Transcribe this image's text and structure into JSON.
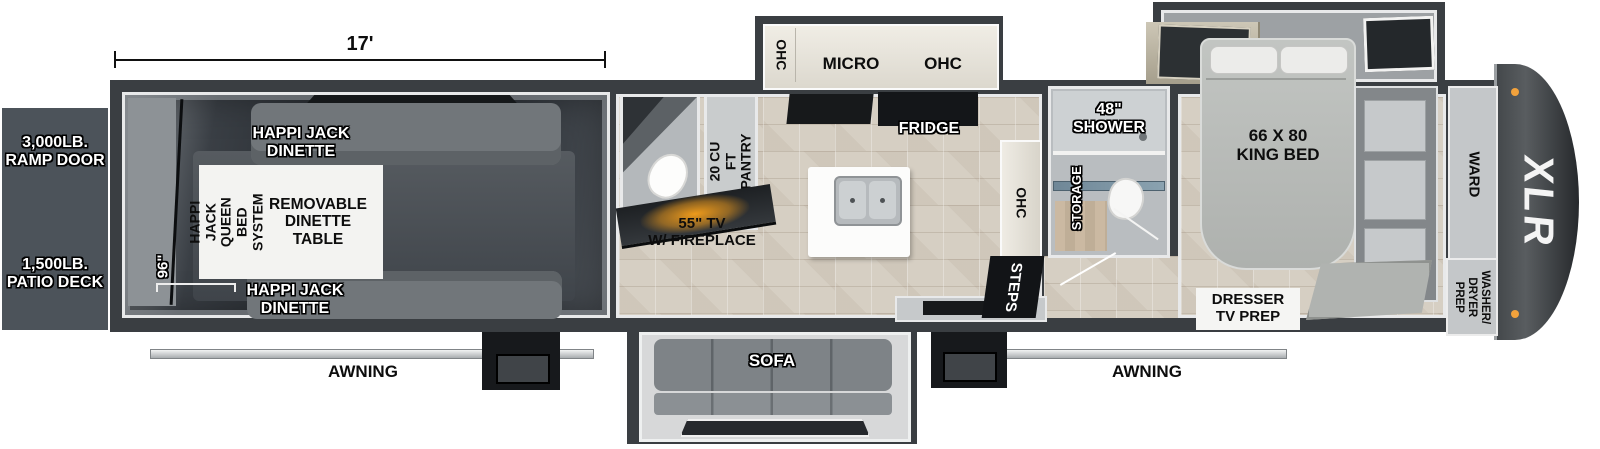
{
  "title": "XLR Toy Hauler Floorplan",
  "brand": "XLR",
  "colors": {
    "wall": "#3a3e42",
    "trim": "#e8e9ea",
    "ramp_box": "#4c535a",
    "tile_floor": "#d6cfc3",
    "garage_floor": "#2b2f34",
    "fireplace_glow": "#f59a1a",
    "marker_light": "#f2a23c"
  },
  "dimensions": {
    "garage_length": "17'",
    "garage_width": "96\""
  },
  "exterior": {
    "ramp_door": "3,000LB.\nRAMP DOOR",
    "patio_deck": "1,500LB.\nPATIO DECK",
    "awning_left": "AWNING",
    "awning_right": "AWNING"
  },
  "garage": {
    "dinette_top": "HAPPI JACK\nDINETTE",
    "dinette_bottom": "HAPPI JACK\nDINETTE",
    "queen_bed_system": "HAPPI JACK\nQUEEN BED\nSYSTEM",
    "dinette_table": "REMOVABLE\nDINETTE\nTABLE"
  },
  "entry": {
    "pantry": "20 CU FT\nPANTRY",
    "tv_fireplace": "55\" TV\nW/ FIREPLACE"
  },
  "kitchen": {
    "ohc_left": "OHC",
    "micro": "MICRO",
    "ohc_right": "OHC",
    "fridge": "FRIDGE",
    "ohc_side": "OHC",
    "steps": "STEPS",
    "sofa": "SOFA"
  },
  "bathroom": {
    "shower": "48\"\nSHOWER",
    "storage": "STORAGE"
  },
  "bedroom": {
    "king_bed": "66 X 80\nKING BED",
    "dresser": "DRESSER\nTV PREP",
    "ward": "WARD",
    "washer_dryer": "WASHER/\nDRYER\nPREP"
  }
}
